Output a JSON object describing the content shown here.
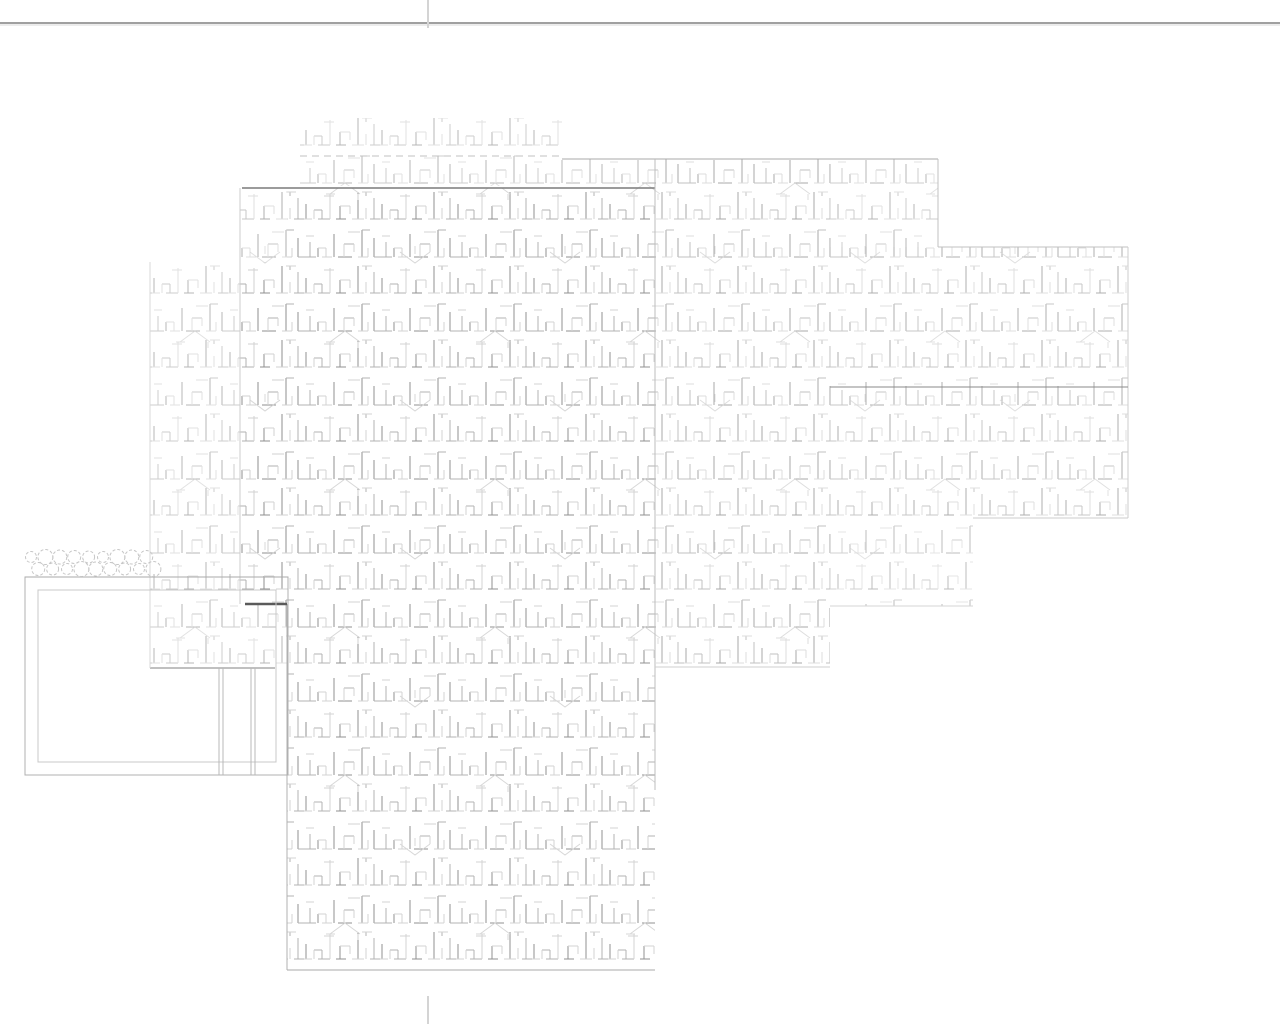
{
  "page": {
    "width": 1280,
    "height": 1024,
    "background": "#ffffff",
    "divider": {
      "y": 23,
      "color": "#a0a0a0",
      "shadow_color": "#d8d8d8",
      "x1": 0,
      "x2": 1280
    },
    "fold_marks": [
      {
        "name": "top-center",
        "x": 428,
        "y1": 0,
        "y2": 28
      },
      {
        "name": "bottom-center",
        "x": 428,
        "y1": 996,
        "y2": 1024
      }
    ],
    "fold_mark_color": "#d4d4d4"
  },
  "drawing": {
    "type": "architectural-roof-plan-shake-shingle-hatch",
    "hatch_colors": {
      "dark": "#6e6e6e",
      "mid": "#9a9a9a",
      "light": "#c4c4c4",
      "arrow": "#d5d5d5"
    },
    "blocks": [
      {
        "name": "top-strip",
        "x": 300,
        "y": 118,
        "w": 262,
        "h": 68,
        "opacity": 0.5
      },
      {
        "name": "mid-right-bridge",
        "x": 562,
        "y": 159,
        "w": 93,
        "h": 29,
        "opacity": 0.5
      },
      {
        "name": "mid-right",
        "x": 655,
        "y": 159,
        "w": 175,
        "h": 508,
        "opacity": 0.6
      },
      {
        "name": "upper-right",
        "x": 830,
        "y": 159,
        "w": 108,
        "h": 88,
        "opacity": 0.5
      },
      {
        "name": "far-right",
        "x": 830,
        "y": 247,
        "w": 298,
        "h": 271,
        "opacity": 0.55
      },
      {
        "name": "right-extension",
        "x": 830,
        "y": 518,
        "w": 143,
        "h": 88,
        "opacity": 0.45
      },
      {
        "name": "left-wing",
        "x": 150,
        "y": 262,
        "w": 137,
        "h": 406,
        "opacity": 0.5
      },
      {
        "name": "central-left-sliver",
        "x": 240,
        "y": 188,
        "w": 47,
        "h": 416,
        "opacity": 0.55
      },
      {
        "name": "central-main",
        "x": 287,
        "y": 188,
        "w": 368,
        "h": 782,
        "opacity": 0.75
      }
    ],
    "edges": [
      {
        "name": "central-top-eave",
        "x1": 242,
        "y1": 188,
        "x2": 655,
        "y2": 188,
        "color": "#7a7a7a",
        "w": 1.5
      },
      {
        "name": "right-top-eave",
        "x1": 562,
        "y1": 159,
        "x2": 938,
        "y2": 159,
        "color": "#a8a8a8",
        "w": 1
      },
      {
        "name": "top-strip-dashed-line",
        "x1": 300,
        "y1": 156,
        "x2": 562,
        "y2": 156,
        "color": "#c0c0c0",
        "w": 1,
        "dash": "7 5"
      },
      {
        "name": "valley-vertical",
        "x1": 655,
        "y1": 159,
        "x2": 655,
        "y2": 790,
        "color": "#bdbdbd",
        "w": 1
      },
      {
        "name": "upper-right-side",
        "x1": 938,
        "y1": 159,
        "x2": 938,
        "y2": 247,
        "color": "#c0c0c0",
        "w": 1
      },
      {
        "name": "far-right-top-eave",
        "x1": 938,
        "y1": 247,
        "x2": 1128,
        "y2": 247,
        "color": "#c0c0c0",
        "w": 1
      },
      {
        "name": "far-right-side",
        "x1": 1128,
        "y1": 247,
        "x2": 1128,
        "y2": 518,
        "color": "#cccccc",
        "w": 1
      },
      {
        "name": "far-right-ridge",
        "x1": 830,
        "y1": 387,
        "x2": 1128,
        "y2": 387,
        "color": "#8a8a8a",
        "w": 1
      },
      {
        "name": "far-right-bottom-eave",
        "x1": 973,
        "y1": 518,
        "x2": 1128,
        "y2": 518,
        "color": "#cccccc",
        "w": 1
      },
      {
        "name": "left-wing-bottom-eave",
        "x1": 150,
        "y1": 668,
        "x2": 275,
        "y2": 668,
        "color": "#9a9a9a",
        "w": 1.3
      },
      {
        "name": "central-left-edge-low",
        "x1": 287,
        "y1": 604,
        "x2": 287,
        "y2": 970,
        "color": "#b0b0b0",
        "w": 1
      },
      {
        "name": "central-bottom-eave",
        "x1": 287,
        "y1": 970,
        "x2": 655,
        "y2": 970,
        "color": "#aaaaaa",
        "w": 1
      },
      {
        "name": "dark-wall-segment",
        "x1": 245,
        "y1": 604,
        "x2": 287,
        "y2": 604,
        "color": "#5a5a5a",
        "w": 2.5
      },
      {
        "name": "central-left-edge-up",
        "x1": 240,
        "y1": 188,
        "x2": 240,
        "y2": 604,
        "color": "#cccccc",
        "w": 1
      },
      {
        "name": "mid-right-bottom",
        "x1": 655,
        "y1": 667,
        "x2": 830,
        "y2": 667,
        "color": "#cfcfcf",
        "w": 1
      },
      {
        "name": "right-ext-bottom",
        "x1": 830,
        "y1": 606,
        "x2": 973,
        "y2": 606,
        "color": "#d6d6d6",
        "w": 1
      },
      {
        "name": "left-wing-side",
        "x1": 150,
        "y1": 262,
        "x2": 150,
        "y2": 668,
        "color": "#d8d8d8",
        "w": 1
      }
    ],
    "patio": {
      "outer": {
        "x": 25,
        "y": 577,
        "w": 263,
        "h": 198,
        "color": "#b0b0b0"
      },
      "inner": {
        "x": 38,
        "y": 590,
        "w": 238,
        "h": 172,
        "color": "#c8c8c8"
      },
      "posts": [
        {
          "x": 219,
          "y1": 668,
          "y2": 775
        },
        {
          "x": 223,
          "y1": 668,
          "y2": 775
        },
        {
          "x": 251,
          "y1": 668,
          "y2": 775
        },
        {
          "x": 255,
          "y1": 668,
          "y2": 775
        }
      ],
      "post_color": "#b8b8b8"
    },
    "plants": {
      "x_start": 31,
      "step": 7.2,
      "count": 18,
      "row_ys": [
        557,
        569
      ],
      "radius": 6.5,
      "color": "#c6c6c6",
      "baseline": {
        "x1": 25,
        "y": 577,
        "x2": 288,
        "color": "#aaaaaa"
      }
    }
  }
}
